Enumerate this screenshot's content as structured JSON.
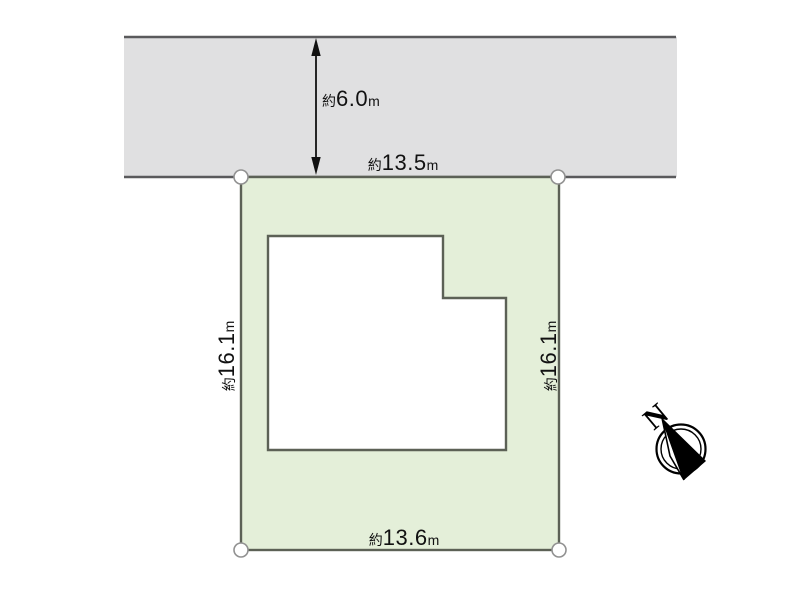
{
  "diagram": {
    "labels": {
      "road_width": {
        "prefix": "約",
        "value": "6.0",
        "unit": "m"
      },
      "frontage_top": {
        "prefix": "約",
        "value": "13.5",
        "unit": "m"
      },
      "depth_left": {
        "prefix": "約",
        "value": "16.1",
        "unit": "m"
      },
      "depth_right": {
        "prefix": "約",
        "value": "16.1",
        "unit": "m"
      },
      "frontage_bottom": {
        "prefix": "約",
        "value": "13.6",
        "unit": "m"
      }
    },
    "compass": {
      "north_label": "N"
    },
    "colors": {
      "road_fill": "#e0e0e1",
      "road_border": "#5a5a5c",
      "plot_fill": "#e4efd9",
      "plot_border": "#5c6156",
      "building_fill": "#ffffff",
      "building_border": "#5c6156",
      "marker_fill": "#ffffff",
      "marker_stroke": "#919191",
      "dimension_color": "#111111",
      "compass_color": "#000000"
    }
  }
}
